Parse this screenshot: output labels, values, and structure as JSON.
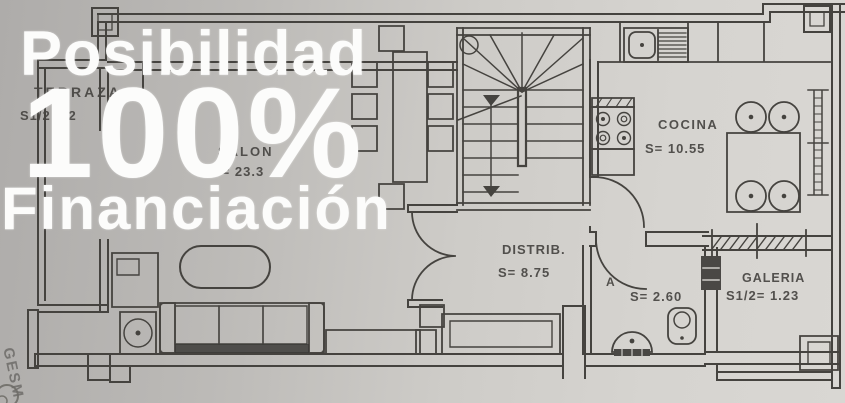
{
  "watermark": {
    "line1": "Posibilidad",
    "line2": "100%",
    "line3": "Financiación"
  },
  "rooms": {
    "terraza": {
      "name": "TERRAZA",
      "area": "S1/2 = 2"
    },
    "salon": {
      "name": "SALON",
      "area": "S= 23.3"
    },
    "cocina": {
      "name": "COCINA",
      "area": "S= 10.55"
    },
    "distribuidor": {
      "name": "DISTRIB.",
      "area": "S= 8.75"
    },
    "aseo": {
      "name": "A",
      "area": "S= 2.60"
    },
    "galeria": {
      "name": "GALERIA",
      "area": "S1/2= 1.23"
    }
  },
  "stamp": {
    "text": "GESM"
  },
  "colors": {
    "paper_left": "#aeacaa",
    "paper_right": "#d9d7d3",
    "ink": "#45433f",
    "watermark_text": "#fcfcfb"
  }
}
